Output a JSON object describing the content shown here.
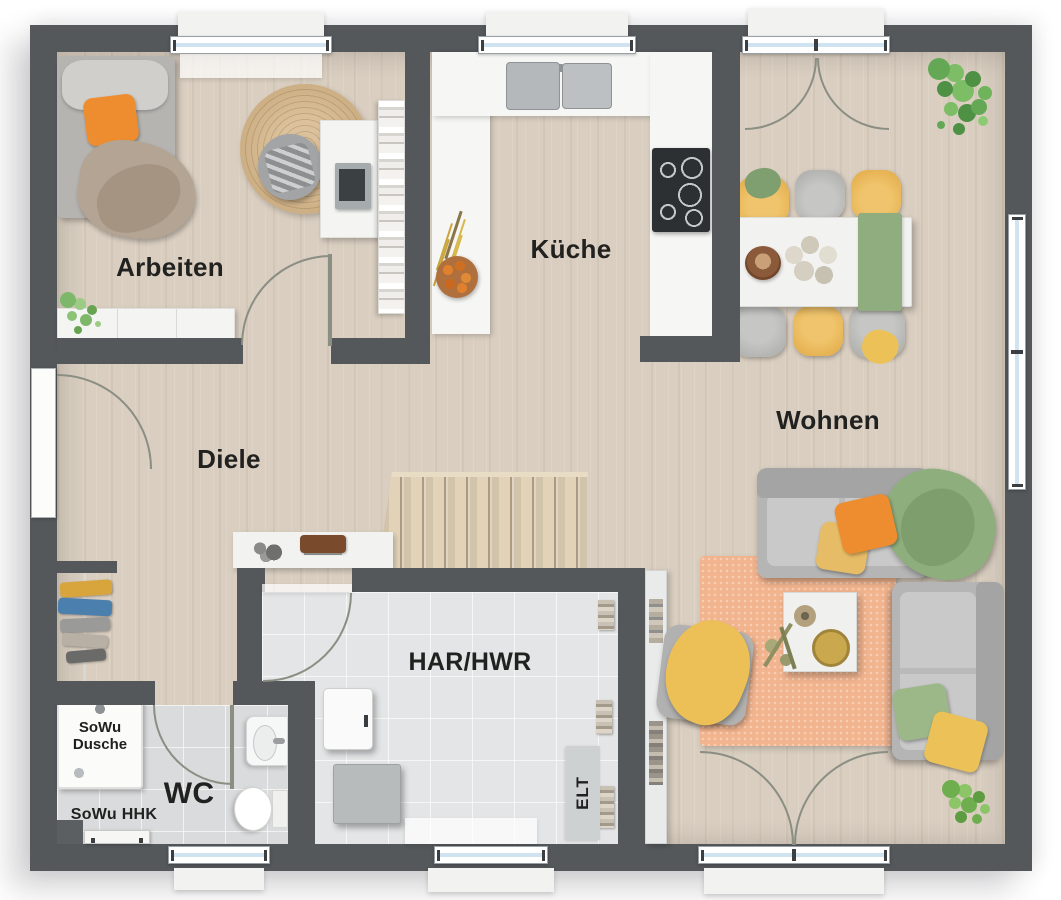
{
  "floor_plan": {
    "rooms": {
      "arbeiten": {
        "label": "Arbeiten"
      },
      "kueche": {
        "label": "Küche"
      },
      "wohnen": {
        "label": "Wohnen"
      },
      "diele": {
        "label": "Diele"
      },
      "har_hwr": {
        "label": "HAR/HWR"
      },
      "wc": {
        "label": "WC"
      }
    },
    "annotations": {
      "shower_label_line1": "SoWu",
      "shower_label_line2": "Dusche",
      "heater_label": "SoWu HHK",
      "electrical_label": "ELT"
    },
    "colors": {
      "wall": "#54585b",
      "wood_floor": "#d9cec0",
      "tile_floor": "#e3e4e5",
      "rug": "#f2b48e",
      "sofa_gray": "#b4b5b4",
      "accent_orange": "#ee8d2f",
      "accent_yellow": "#e9bc5c",
      "accent_green": "#8fae7d",
      "window_glass": "#cfe4f0"
    }
  }
}
